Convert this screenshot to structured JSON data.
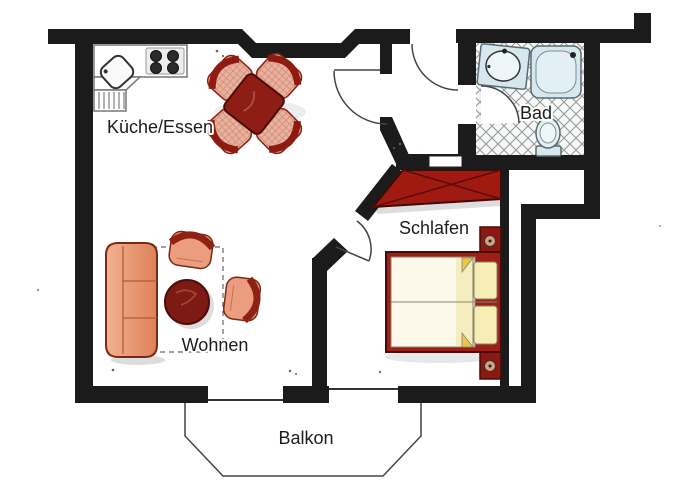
{
  "rooms": {
    "kitchen_dining": {
      "label": "Küche/Essen"
    },
    "bathroom": {
      "label": "Bad"
    },
    "bedroom": {
      "label": "Schlafen"
    },
    "living_room": {
      "label": "Wohnen"
    },
    "balcony": {
      "label": "Balkon"
    }
  },
  "colors": {
    "wall": "#1b1b1b",
    "wood_red": "#8e1d15",
    "upholstery": "#ec9d7f",
    "bath_fixture": "#d6e7ee",
    "bedding": "#fcf9ea",
    "pillow": "#f6eeb5",
    "line": "#444444",
    "label_text": "#1c1c1c"
  },
  "furniture_icons": [
    "kitchen-counter",
    "stove-burners",
    "kitchen-sink",
    "dishwasher-hatch",
    "dining-table",
    "dining-chair",
    "sofa",
    "coffee-table",
    "armchair",
    "seating-area-outline",
    "wardrobe",
    "double-bed",
    "headboard",
    "bath-sink",
    "shower",
    "toilet",
    "balcony-outline"
  ]
}
